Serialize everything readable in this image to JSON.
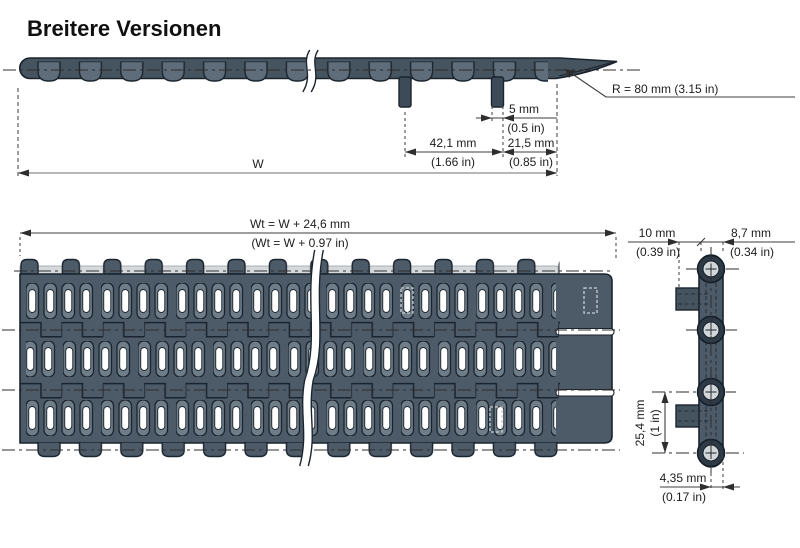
{
  "title": "Breitere Versionen",
  "side_view": {
    "radius_label": "R = 80 mm (3.15 in)",
    "width_label": "W",
    "tab_width_mm": "5 mm",
    "tab_width_in": "(0.5 in)",
    "tab_spacing_mm": "42,1 mm",
    "tab_spacing_in": "(1.66 in)",
    "edge_offset_mm": "21,5 mm",
    "edge_offset_in": "(0.85 in)"
  },
  "top_view": {
    "total_width_mm": "Wt = W + 24,6 mm",
    "total_width_in": "(Wt = W + 0.97 in)"
  },
  "end_view": {
    "tab_length_mm": "10 mm",
    "tab_length_in": "(0.39 in)",
    "edge_width_mm": "8,7 mm",
    "edge_width_in": "(0.34 in)",
    "pitch_mm": "25,4 mm",
    "pitch_in": "(1 in)",
    "pin_offset_mm": "4,35 mm",
    "pin_offset_in": "(0.17 in)"
  },
  "colors": {
    "body": "#46545f",
    "plan_body": "#4d5a68",
    "knuckle": "#5f6d7b",
    "slot_rim": "#6f7d89",
    "pin_ring": "#2e3a46",
    "pin_hole": "#d3d6d9",
    "light_band": "#d5d9dc",
    "outline": "#1a242e",
    "dim_line": "#3c3c3c"
  }
}
